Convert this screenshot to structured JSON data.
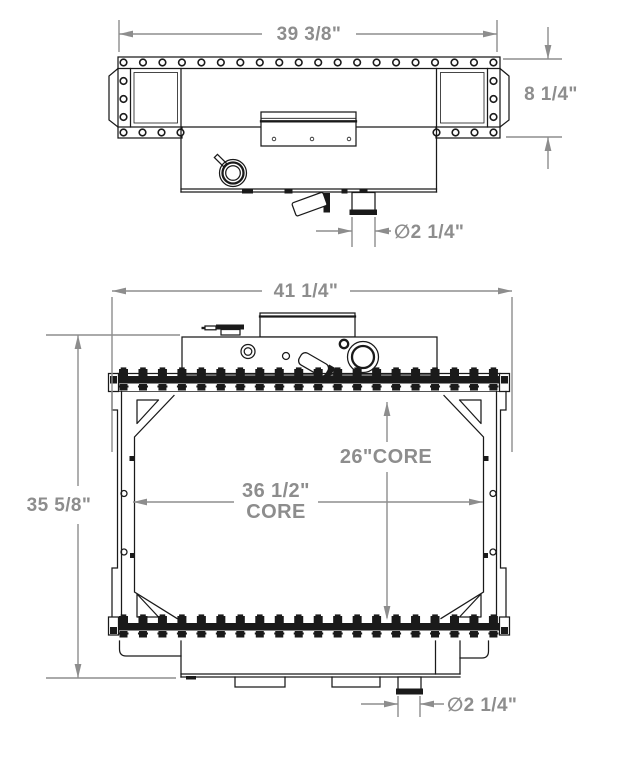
{
  "drawing": {
    "top_view": {
      "width_dim": "39 3/8\"",
      "depth_dim": "8 1/4\"",
      "outlet_dim": "∅2 1/4\""
    },
    "front_view": {
      "width_dim": "41 1/4\"",
      "height_dim": "35 5/8\"",
      "core_height_dim": "26\"CORE",
      "core_width_dim_line1": "36 1/2\"",
      "core_width_dim_line2": "CORE",
      "outlet_dim": "∅2 1/4\""
    },
    "colors": {
      "line": "#1a1a1a",
      "dimension": "#8d8d8d",
      "background": "#ffffff"
    }
  }
}
